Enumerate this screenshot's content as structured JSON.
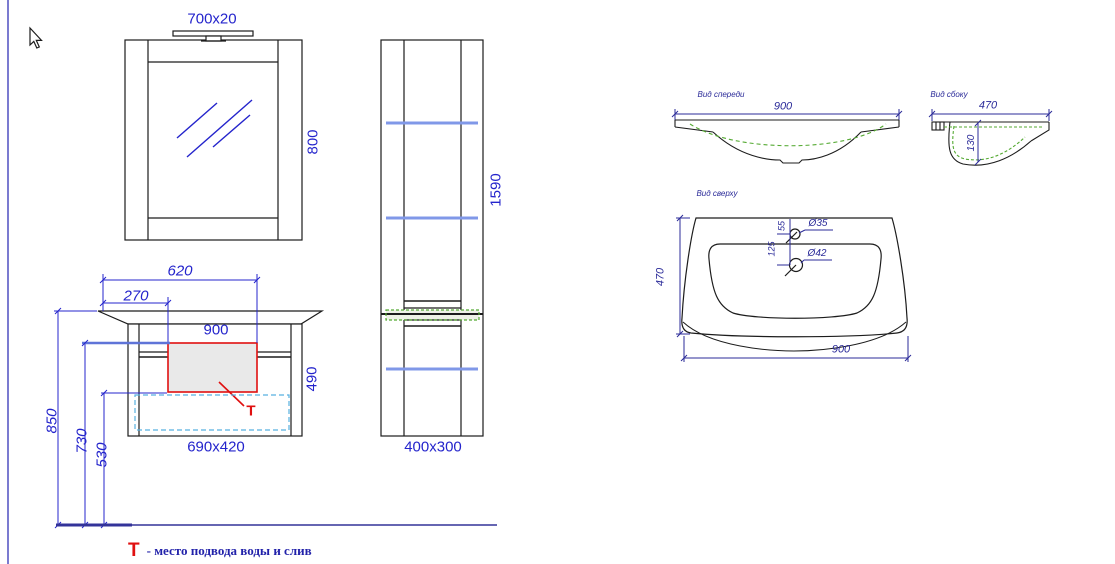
{
  "colors": {
    "dim_blue": "#2424cc",
    "navy": "#2b2b99",
    "line_black": "#1c1c1c",
    "shelf_blue": "#8098e8",
    "green_dash": "#55aa33",
    "cyan_dash": "#58b0e0",
    "red": "#e01010",
    "frame_purple": "#7b7bd0",
    "floor_navy": "#333399"
  },
  "mirror": {
    "lamp_size": "700x20",
    "height": "800"
  },
  "tall_cabinet": {
    "height": "1590",
    "footprint": "400x300"
  },
  "vanity": {
    "top_offset_620": "620",
    "top_offset_270": "270",
    "width_900": "900",
    "height_490": "490",
    "drawer_size": "690x420",
    "floor_height_850": "850",
    "floor_height_730": "730",
    "floor_height_530": "530",
    "t_marker": "Т"
  },
  "legend": {
    "marker": "Т",
    "text": "- место подвода воды и слив"
  },
  "sink_views": {
    "front": {
      "label": "Вид спереди",
      "width_900": "900"
    },
    "side": {
      "label": "Вид сбоку",
      "width_470": "470",
      "depth_130": "130"
    },
    "top": {
      "label": "Вид сверху",
      "depth_470": "470",
      "width_900": "900",
      "faucet_hole_d35": "Ø35",
      "drain_hole_d42": "Ø42",
      "faucet_offset_55": "55",
      "drain_offset_125": "125"
    }
  }
}
